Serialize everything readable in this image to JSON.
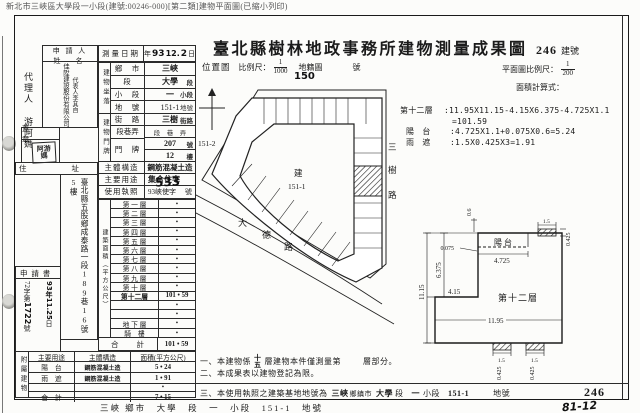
{
  "meta_line": "新北市三峽區大學段一小段(建號:00246-000)[第二類]建物平面圖(已縮小列印)",
  "header": {
    "title": "臺北縣樹林地政事務所建物測量成果圖",
    "building_no": "246",
    "building_no_unit": "建號"
  },
  "margin": {
    "agent": "代理人 游阿媽"
  },
  "form": {
    "applicant": {
      "label1": "申 請 人",
      "label2": "姓　名",
      "company": "佳陞建設股份有限公司",
      "rep": "代表人李其自"
    },
    "seal": {
      "label": "蓋　章",
      "stamp1": "阿游",
      "stamp2": "媽"
    },
    "address": {
      "label": "住　　址",
      "value": "臺北縣五股鄉成泰路一段189巷16號5樓"
    },
    "application": {
      "label": "申 請 書",
      "no_pre": "72字第",
      "no_hand": "1722",
      "no_suf": "號",
      "date_hand": "93年11.25",
      "date_suf": "日"
    },
    "survey": {
      "label": "測量日期",
      "t1": "年",
      "y": "93",
      "m": "12.",
      "d": "2",
      "t2": "日"
    },
    "location": {
      "strip": "建物坐落",
      "rows": [
        {
          "label": "鄉　市",
          "value": "三峽",
          "suffix": ""
        },
        {
          "label": "段",
          "value": "大學",
          "suffix": "段"
        },
        {
          "label": "小　段",
          "value": "一",
          "suffix": "小段"
        },
        {
          "label": "地　號",
          "value": "151-1",
          "suffix": "地號"
        }
      ]
    },
    "door": {
      "strip": "建物門牌",
      "rows": [
        {
          "label": "街　路",
          "value": "三樹",
          "suffix": "街路"
        },
        {
          "label": "段巷弄",
          "value": "段　巷　弄",
          "suffix": ""
        },
        {
          "label": "門　牌",
          "value": "207",
          "suffix": "號"
        },
        {
          "label": "",
          "value": "12",
          "suffix": "樓"
        }
      ]
    },
    "structure": {
      "label": "主體構造",
      "value": "鋼筋混凝土造"
    },
    "usage": {
      "label": "主要用途",
      "value": "集合住宅"
    },
    "license": {
      "label": "使用執照",
      "prefix": "93峽使字",
      "hand": "533",
      "suffix": "號"
    },
    "floor_area": {
      "strip": "建築面積（平方公尺）",
      "rows": [
        {
          "label": "第 一 層",
          "value": "•"
        },
        {
          "label": "第 二 層",
          "value": "•"
        },
        {
          "label": "第 三 層",
          "value": "•"
        },
        {
          "label": "第 四 層",
          "value": "•"
        },
        {
          "label": "第 五 層",
          "value": "•"
        },
        {
          "label": "第 六 層",
          "value": "•"
        },
        {
          "label": "第 七 層",
          "value": "•"
        },
        {
          "label": "第 八 層",
          "value": "•"
        },
        {
          "label": "第 九 層",
          "value": "•"
        },
        {
          "label": "第 十 層",
          "value": "•"
        },
        {
          "label": "第十二層",
          "value": "101 • 59"
        },
        {
          "label": "",
          "value": "•"
        },
        {
          "label": "",
          "value": "•"
        },
        {
          "label": "地 下 層",
          "value": "•"
        },
        {
          "label": "騎　樓",
          "value": "•"
        }
      ],
      "total_label": "合　　計",
      "total_value": "101 • 59"
    },
    "annex": {
      "strip": "附屬建物",
      "h1": "主要用途",
      "h2": "主體構造",
      "h3": "面積(平方公尺)",
      "rows": [
        {
          "c1": "陽　台",
          "c2": "鋼筋混凝土造",
          "c3": "5 • 24"
        },
        {
          "c1": "雨　遮",
          "c2": "鋼筋混凝土造",
          "c3": "1 • 91"
        },
        {
          "c1": "",
          "c2": "",
          "c3": "•"
        },
        {
          "c1": "合　計",
          "c2": "",
          "c3": "7 • 15"
        }
      ]
    }
  },
  "map": {
    "title": "位置圖",
    "scale_label": "比例尺：",
    "scale_num": "1",
    "scale_den": "1000",
    "sheet": "地籍圖",
    "sheet_unit": "號",
    "sheet_hand": "150",
    "north_parcel": "151-2",
    "parcel_line1": "建",
    "parcel_line2": "151-1",
    "road_right": [
      "三",
      "樹",
      "路"
    ],
    "road_bottom": [
      "大",
      "德",
      "路"
    ]
  },
  "plan": {
    "scale_label": "平面圖比例尺：",
    "scale_num": "1",
    "scale_den": "200",
    "calc_label": "面積計算式：",
    "calc": [
      {
        "name": "第十二層",
        "line1": ":11.95X11.15-4.15X6.375-4.725X1.1",
        "line2": "=101.59"
      },
      {
        "name": "陽　台",
        "line1": ":4.725X1.1+0.075X0.6=5.24",
        "line2": ""
      },
      {
        "name": "雨　遮",
        "line1": ":1.5X0.425X3=1.91",
        "line2": ""
      }
    ],
    "floor_label": "第十二層",
    "balcony_label": "陽台",
    "dims": {
      "left": "11.15",
      "upper": "6.375",
      "notch": "4.15",
      "bottom": "11.95",
      "balcony": "4.725",
      "step": "0.075",
      "top": "0.6",
      "canopy_w": "1.5",
      "canopy_d": "0.425"
    }
  },
  "notes": {
    "n1a": "一、本建物係",
    "n1_top": "十",
    "n1_bot": "五",
    "n1b": "層建物本件僅測量第",
    "n1c": "層部分。",
    "n2": "二、本成果表以建物登記為限。",
    "n3a": "三、本使用執照之建築基地地號為",
    "n3_town": "三峽",
    "n3_town_u": "鄉鎮市",
    "n3_sec": "大學",
    "n3_sec_u": "段",
    "n3_sub": "一",
    "n3_sub_u": "小段",
    "n3_no": "151-1",
    "n3_no_u": "地號",
    "big_no": "246"
  },
  "footer": {
    "line": "三峽 鄉市　大學　段　一　小段　151-1　地號",
    "hand": "81-12"
  }
}
